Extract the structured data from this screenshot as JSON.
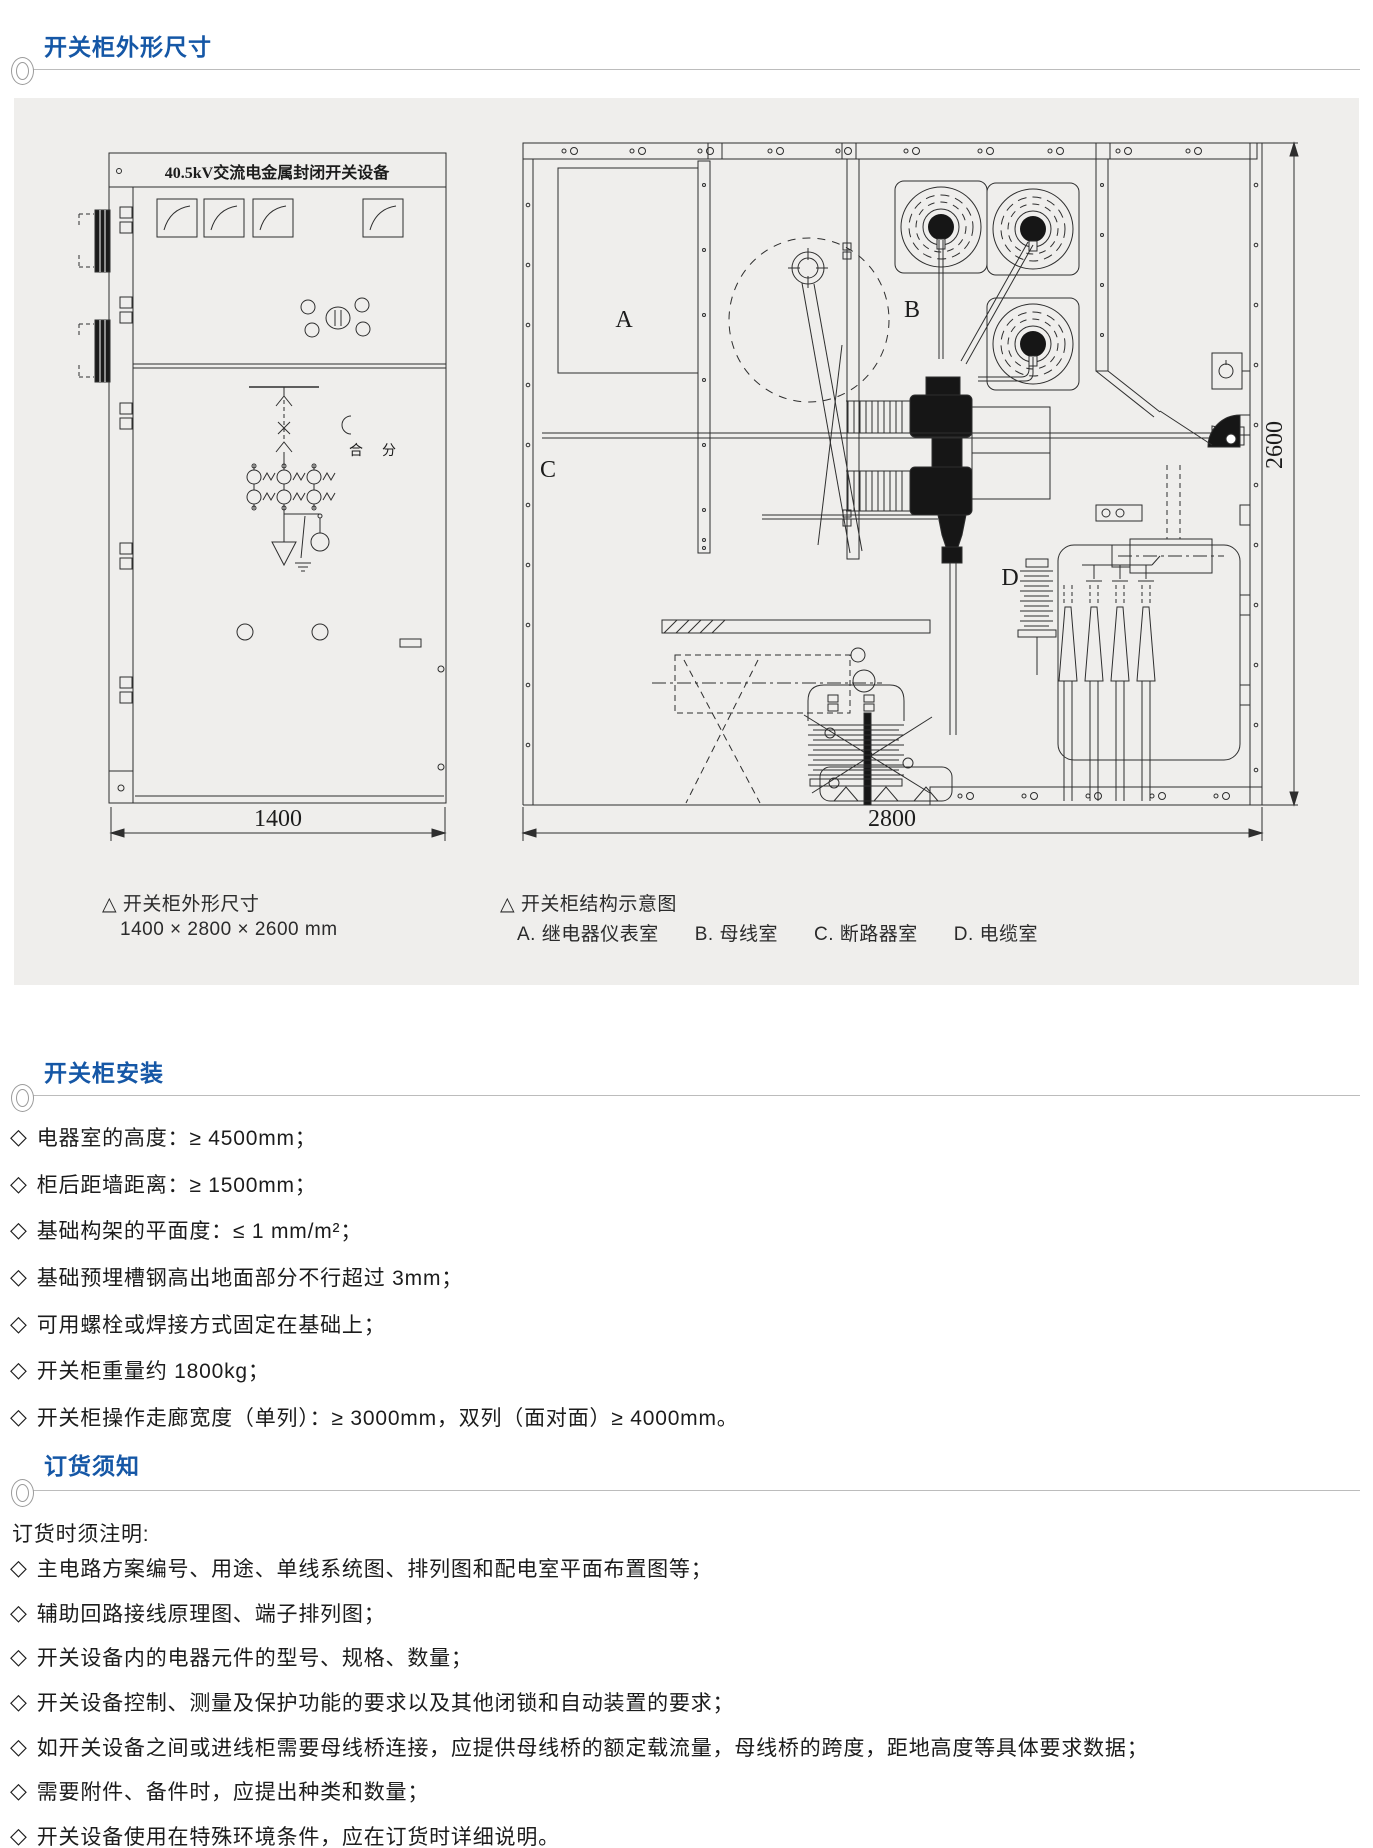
{
  "colors": {
    "accent": "#1557a6",
    "panel": "#efeeec",
    "stroke": "#2e2e2e"
  },
  "symbols": {
    "bullet": "◇"
  },
  "sections": {
    "dimensions": {
      "title": "开关柜外形尺寸"
    },
    "installation": {
      "title": "开关柜安装",
      "items": [
        "电器室的高度：≥ 4500mm；",
        "柜后距墙距离：≥ 1500mm；",
        "基础构架的平面度：≤ 1 mm/m²；",
        "基础预埋槽钢高出地面部分不行超过 3mm；",
        "可用螺栓或焊接方式固定在基础上；",
        "开关柜重量约 1800kg；",
        "开关柜操作走廊宽度（单列）：≥ 3000mm，双列（面对面）≥ 4000mm。"
      ]
    },
    "ordering": {
      "title": "订货须知",
      "intro": "订货时须注明:",
      "items": [
        "主电路方案编号、用途、单线系统图、排列图和配电室平面布置图等；",
        "辅助回路接线原理图、端子排列图；",
        "开关设备内的电器元件的型号、规格、数量；",
        "开关设备控制、测量及保护功能的要求以及其他闭锁和自动装置的要求；",
        "如开关设备之间或进线柜需要母线桥连接，应提供母线桥的额定载流量，母线桥的跨度，距地高度等具体要求数据；",
        "需要附件、备件时，应提出种类和数量；",
        "开关设备使用在特殊环境条件，应在订货时详细说明。"
      ]
    }
  },
  "drawings": {
    "front_view": {
      "nameplate": "40.5kV交流电金属封闭开关设备",
      "close_label": "合",
      "open_label": "分",
      "width_dim": "1400"
    },
    "section_view": {
      "room_a": "A",
      "room_b": "B",
      "room_c": "C",
      "room_d": "D",
      "width_dim": "2800",
      "height_dim": "2600"
    }
  },
  "captions": {
    "left_title": "△ 开关柜外形尺寸",
    "left_size": "1400 × 2800 × 2600 mm",
    "right_title": "△ 开关柜结构示意图",
    "right_rooms": [
      "A. 继电器仪表室",
      "B. 母线室",
      "C. 断路器室",
      "D. 电缆室"
    ]
  }
}
